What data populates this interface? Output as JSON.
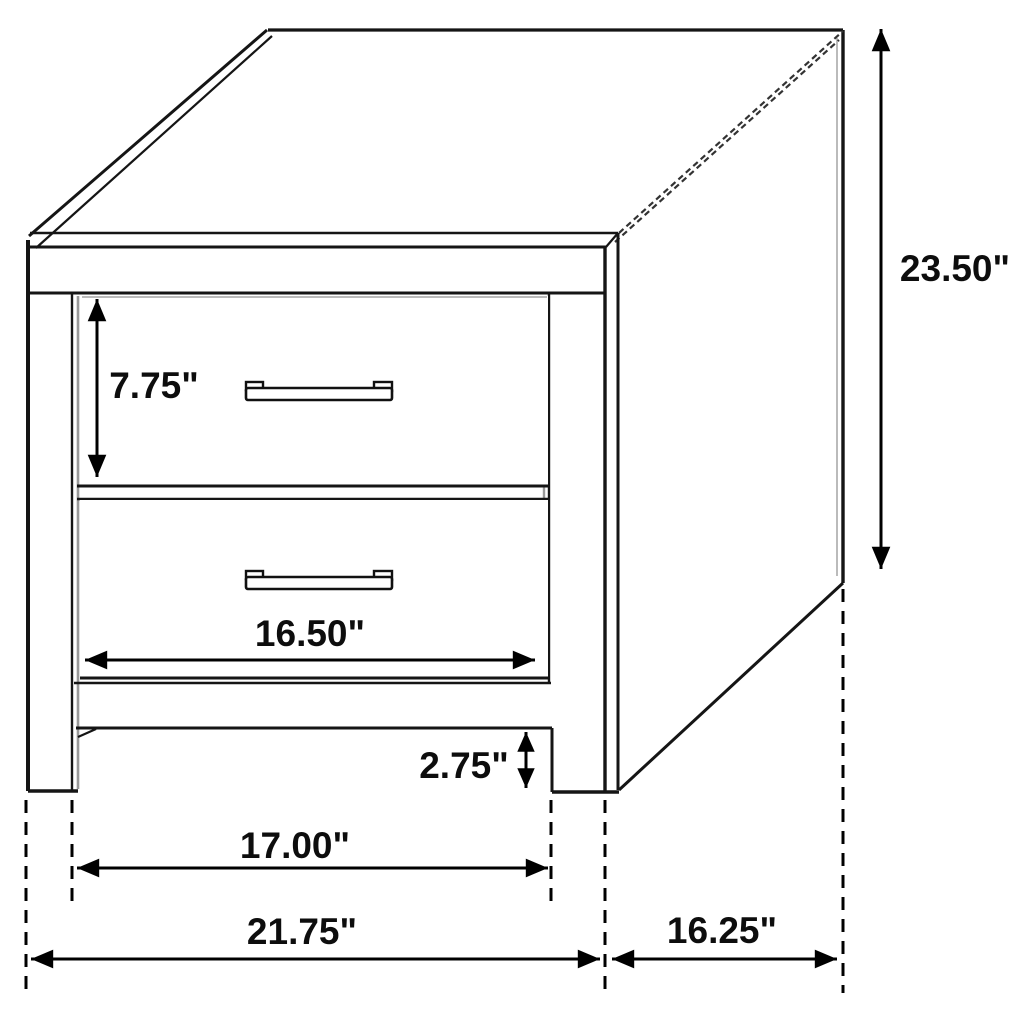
{
  "diagram": {
    "subject": "two-drawer nightstand dimension drawing",
    "unit_symbol": "\"",
    "dimensions": {
      "overall_height": "23.50\"",
      "top_drawer_height": "7.75\"",
      "drawer_front_width": "16.50\"",
      "leg_height": "2.75\"",
      "inner_leg_span": "17.00\"",
      "overall_width": "21.75\"",
      "overall_depth": "16.25\""
    }
  }
}
